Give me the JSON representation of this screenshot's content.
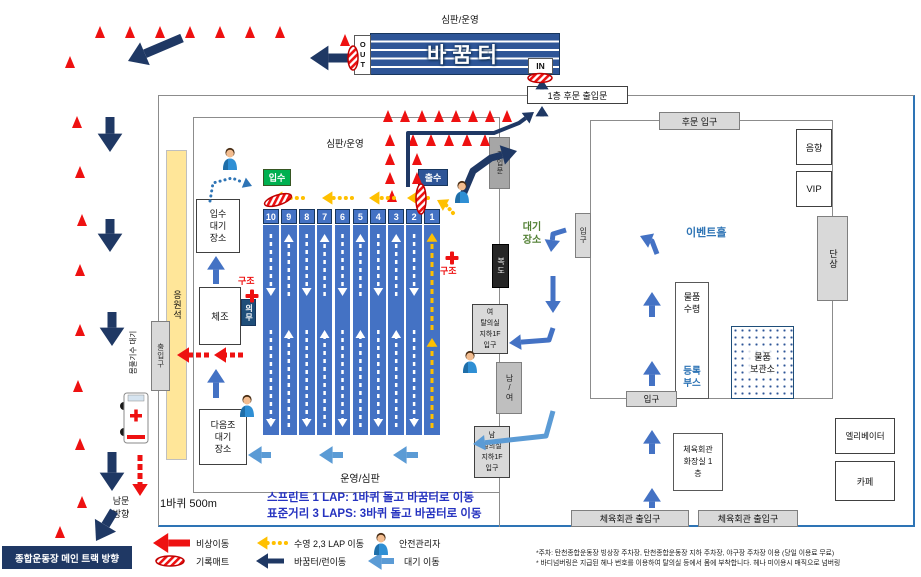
{
  "top": {
    "referee": "심판/운영",
    "transition": "바꿈터",
    "out": "OUT",
    "in": "IN",
    "rear_door": "1층 후문 출입문"
  },
  "pool": {
    "referee": "심판/운영",
    "referee_bottom": "운영/심판",
    "enter_badge": "입수",
    "exit_badge": "출수",
    "enter_wait": "입수\n대기\n장소",
    "warmup": "체조",
    "next_wait": "다음조\n대기\n장소",
    "medical": "의무",
    "rescue_l": "구조",
    "rescue_r": "구조",
    "cheering": "응원석",
    "left_exit": "출입구",
    "warmup_wait": "몸풀기수 대기",
    "lap_note": "1바퀴 500m",
    "sprint_note": "스프린트 1 LAP: 1바퀴 돌고 바꿈터로 이동",
    "standard_note": "표준거리 3 LAPS: 3바퀴 돌고 바꿈터로 이동",
    "lanes": [
      "10",
      "9",
      "8",
      "7",
      "6",
      "5",
      "4",
      "3",
      "2",
      "1"
    ],
    "lane_dirs": [
      "down",
      "up",
      "down",
      "up",
      "down",
      "up",
      "down",
      "up",
      "down",
      "yellow"
    ]
  },
  "corridor": {
    "wait_area": "대기\n장소",
    "top_door": "출입문",
    "hallway": "복도",
    "locker_w": "여\n탈의실\n지하1F\n입구",
    "mf_door": "남/여",
    "locker_m": "남\n탈의실\n지하1F\n입구",
    "right_door": "입구"
  },
  "hall": {
    "rear_entrance": "후문 입구",
    "sound": "음향",
    "vip": "VIP",
    "name": "이벤트홀",
    "stage": "단상",
    "pickup": "물품\n수령",
    "registration": "등록\n부스",
    "storage": "물품\n보관소",
    "entrance": "입구",
    "elevator": "엘리베이터",
    "restroom": "체육회관\n화장실 1\n층",
    "cafe": "카페",
    "gym_door_left": "체육회관 출입구",
    "gym_door_right": "체육회관 출입구"
  },
  "outside": {
    "south_gate": "남문\n방향",
    "main_track": "종합운동장 메인 트랙 방향"
  },
  "legend": {
    "items": [
      {
        "label": "비상이동",
        "icon": "red-arrow"
      },
      {
        "label": "기록매트",
        "icon": "timing-mat"
      },
      {
        "label": "수영 2,3 LAP 이동",
        "icon": "yellow-dotted-arrow"
      },
      {
        "label": "바꿈터/런이동",
        "icon": "navy-arrow"
      },
      {
        "label": "안전관리자",
        "icon": "person"
      },
      {
        "label": "대기 이동",
        "icon": "blue-arrow"
      }
    ]
  },
  "footnotes": [
    "*주차: 탄천종합운동장 빙상장 주차장, 탄천종합운동장 지하 주차장, 야구장 주차장 이용 (당일 이용료 무료)",
    "* 바디넘버링은 지급된 헤나 번호를 이용하여 탈의실 등에서 몸에 부착합니다. 헤나 미이용시 매직으로 넘버링"
  ],
  "diagram": {
    "colors": {
      "navy": "#1f3864",
      "red": "#ee1111",
      "yel": "#ffc000",
      "blu": "#5b9bd5",
      "mblu": "#4472c4",
      "dblu": "#2e74b5",
      "wht": "#ffffff",
      "cone": "#ee1111",
      "mat_stroke": "#c00000",
      "green_badge": "#00b050",
      "blue_badge": "#2e5597"
    },
    "cones": [
      [
        100,
        38
      ],
      [
        130,
        38
      ],
      [
        160,
        38
      ],
      [
        190,
        38
      ],
      [
        220,
        38
      ],
      [
        250,
        38
      ],
      [
        280,
        38
      ],
      [
        345,
        46
      ],
      [
        70,
        68
      ],
      [
        77,
        128
      ],
      [
        80,
        178
      ],
      [
        82,
        226
      ],
      [
        80,
        276
      ],
      [
        80,
        336
      ],
      [
        78,
        392
      ],
      [
        80,
        450
      ],
      [
        82,
        508
      ],
      [
        60,
        538
      ],
      [
        388,
        122
      ],
      [
        405,
        122
      ],
      [
        422,
        122
      ],
      [
        439,
        122
      ],
      [
        456,
        122
      ],
      [
        473,
        122
      ],
      [
        490,
        122
      ],
      [
        507,
        122
      ],
      [
        413,
        146
      ],
      [
        431,
        146
      ],
      [
        449,
        146
      ],
      [
        467,
        146
      ],
      [
        485,
        146
      ],
      [
        390,
        146
      ],
      [
        390,
        165
      ],
      [
        390,
        184
      ],
      [
        392,
        202
      ],
      [
        417,
        165
      ],
      [
        417,
        184
      ]
    ],
    "arrows": [
      {
        "p": [
          [
            182,
            38
          ],
          [
            128,
            61
          ]
        ],
        "c": "navy",
        "w": 9
      },
      {
        "p": [
          [
            110,
            117
          ],
          [
            110,
            152
          ]
        ],
        "c": "navy",
        "w": 9
      },
      {
        "p": [
          [
            110,
            219
          ],
          [
            110,
            252
          ]
        ],
        "c": "navy",
        "w": 9
      },
      {
        "p": [
          [
            112,
            312
          ],
          [
            112,
            346
          ]
        ],
        "c": "navy",
        "w": 9
      },
      {
        "p": [
          [
            112,
            452
          ],
          [
            112,
            491
          ]
        ],
        "c": "navy",
        "w": 9
      },
      {
        "p": [
          [
            114,
            511
          ],
          [
            96,
            541
          ]
        ],
        "c": "navy",
        "w": 9
      },
      {
        "p": [
          [
            140,
            455
          ],
          [
            140,
            496
          ]
        ],
        "c": "red",
        "w": 5,
        "d": "6 3"
      },
      {
        "p": [
          [
            348,
            58
          ],
          [
            310,
            58
          ]
        ],
        "c": "navy",
        "w": 9
      },
      {
        "p": [
          [
            408,
            187
          ],
          [
            408,
            133
          ],
          [
            494,
            133
          ],
          [
            519,
            123
          ],
          [
            534,
            112
          ]
        ],
        "c": "navy",
        "w": 4
      },
      {
        "p": [
          [
            462,
            197
          ],
          [
            473,
            171
          ],
          [
            491,
            158
          ],
          [
            517,
            151
          ]
        ],
        "c": "navy",
        "w": 7
      },
      {
        "p": [
          [
            542,
            116
          ],
          [
            542,
            106
          ]
        ],
        "c": "navy",
        "w": 4
      },
      {
        "p": [
          [
            542,
            87
          ],
          [
            542,
            79
          ]
        ],
        "c": "navy",
        "w": 4
      },
      {
        "p": [
          [
            566,
            230
          ],
          [
            553,
            234
          ],
          [
            551,
            252
          ]
        ],
        "c": "mblu",
        "w": 5
      },
      {
        "p": [
          [
            553,
            276
          ],
          [
            553,
            313
          ]
        ],
        "c": "mblu",
        "w": 5
      },
      {
        "p": [
          [
            553,
            328
          ],
          [
            549,
            340
          ],
          [
            509,
            343
          ]
        ],
        "c": "mblu",
        "w": 5
      },
      {
        "p": [
          [
            553,
            411
          ],
          [
            546,
            436
          ],
          [
            473,
            444
          ]
        ],
        "c": "blu",
        "w": 5
      },
      {
        "p": [
          [
            271,
            455
          ],
          [
            248,
            455
          ]
        ],
        "c": "blu",
        "w": 6
      },
      {
        "p": [
          [
            343,
            455
          ],
          [
            319,
            455
          ]
        ],
        "c": "blu",
        "w": 6
      },
      {
        "p": [
          [
            418,
            455
          ],
          [
            393,
            455
          ]
        ],
        "c": "blu",
        "w": 6
      },
      {
        "p": [
          [
            652,
            317
          ],
          [
            652,
            292
          ]
        ],
        "c": "mblu",
        "w": 6
      },
      {
        "p": [
          [
            652,
            386
          ],
          [
            652,
            361
          ]
        ],
        "c": "mblu",
        "w": 6
      },
      {
        "p": [
          [
            652,
            454
          ],
          [
            652,
            430
          ]
        ],
        "c": "mblu",
        "w": 6
      },
      {
        "p": [
          [
            652,
            508
          ],
          [
            652,
            488
          ]
        ],
        "c": "mblu",
        "w": 6
      },
      {
        "p": [
          [
            657,
            254
          ],
          [
            652,
            241
          ],
          [
            640,
            236
          ]
        ],
        "c": "mblu",
        "w": 5
      },
      {
        "p": [
          [
            210,
            201
          ],
          [
            213,
            183
          ],
          [
            232,
            178
          ],
          [
            252,
            186
          ]
        ],
        "c": "dblu",
        "w": 3,
        "d": "0.1 5",
        "cap": "round"
      },
      {
        "p": [
          [
            216,
            284
          ],
          [
            216,
            256
          ]
        ],
        "c": "mblu",
        "w": 6
      },
      {
        "p": [
          [
            216,
            398
          ],
          [
            216,
            369
          ]
        ],
        "c": "mblu",
        "w": 6
      },
      {
        "p": [
          [
            303,
            198
          ],
          [
            272,
            198
          ]
        ],
        "c": "yel",
        "w": 4,
        "d": "0.1 6",
        "cap": "round"
      },
      {
        "p": [
          [
            352,
            198
          ],
          [
            322,
            198
          ]
        ],
        "c": "yel",
        "w": 4,
        "d": "0.1 6",
        "cap": "round"
      },
      {
        "p": [
          [
            394,
            198
          ],
          [
            369,
            198
          ]
        ],
        "c": "yel",
        "w": 4,
        "d": "0.1 6",
        "cap": "round"
      },
      {
        "p": [
          [
            428,
            198
          ],
          [
            407,
            198
          ]
        ],
        "c": "yel",
        "w": 4,
        "d": "0.1 6",
        "cap": "round"
      },
      {
        "p": [
          [
            453,
            213
          ],
          [
            446,
            205
          ],
          [
            437,
            200
          ]
        ],
        "c": "yel",
        "w": 4,
        "d": "0.1 5",
        "cap": "round"
      },
      {
        "p": [
          [
            209,
            355
          ],
          [
            177,
            355
          ]
        ],
        "c": "red",
        "w": 5,
        "d": "5 3"
      },
      {
        "p": [
          [
            243,
            355
          ],
          [
            214,
            355
          ]
        ],
        "c": "red",
        "w": 5,
        "d": "5 3"
      },
      {
        "p": [
          [
            190,
            543
          ],
          [
            153,
            543
          ]
        ],
        "c": "red",
        "w": 7
      },
      {
        "p": [
          [
            286,
            543
          ],
          [
            257,
            543
          ]
        ],
        "c": "yel",
        "w": 4,
        "d": "0.1 6",
        "cap": "round"
      },
      {
        "p": [
          [
            284,
            561
          ],
          [
            256,
            561
          ]
        ],
        "c": "navy",
        "w": 5
      },
      {
        "p": [
          [
            394,
            561
          ],
          [
            368,
            561
          ]
        ],
        "c": "blu",
        "w": 6
      }
    ],
    "mats": [
      {
        "x": 278,
        "y": 200,
        "rx": 14,
        "ry": 5,
        "r": -18
      },
      {
        "x": 421,
        "y": 199,
        "rx": 5,
        "ry": 15,
        "r": 0
      },
      {
        "x": 353,
        "y": 58,
        "rx": 5,
        "ry": 12,
        "r": 0
      },
      {
        "x": 540,
        "y": 78,
        "rx": 12,
        "ry": 4.5,
        "r": 0
      },
      {
        "x": 170,
        "y": 561,
        "rx": 14,
        "ry": 5,
        "r": 0
      }
    ],
    "crosses": [
      {
        "x": 252,
        "y": 296
      },
      {
        "x": 452,
        "y": 258
      }
    ],
    "persons": [
      {
        "x": 230,
        "y": 160
      },
      {
        "x": 462,
        "y": 193
      },
      {
        "x": 470,
        "y": 363
      },
      {
        "x": 247,
        "y": 407
      },
      {
        "x": 381,
        "y": 545
      }
    ],
    "ambulance": {
      "x": 124,
      "y": 393,
      "w": 24,
      "h": 50
    }
  }
}
